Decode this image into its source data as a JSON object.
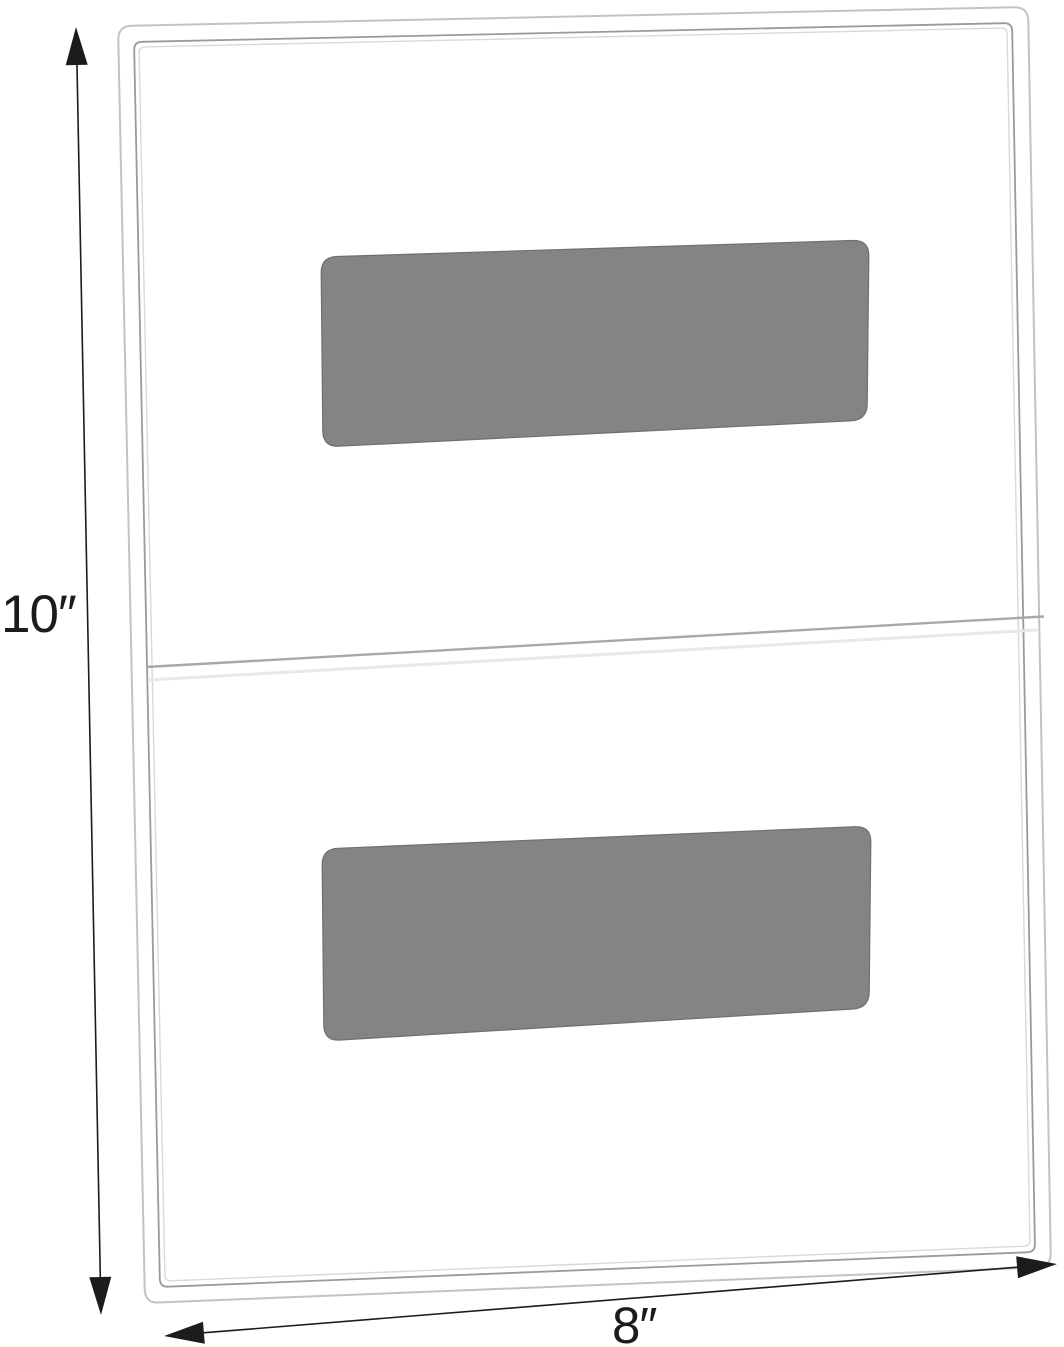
{
  "diagram": {
    "kind": "product-dimension-diagram",
    "dimension_labels": {
      "height": "10″",
      "width": "8″"
    },
    "colors": {
      "background": "#ffffff",
      "frame_outer_edge": "#c3c3c3",
      "frame_inner_edge": "#9a9a9a",
      "frame_inner_highlight": "#d9d9d9",
      "center_seam": "#a8a8a8",
      "center_seam_highlight": "#e8e8e8",
      "adhesive_pad": "#848484",
      "adhesive_pad_edge": "#6f6f6f",
      "dimension_arrow": "#1c1c1c",
      "label_text": "#1c1c1c"
    },
    "parts": {
      "frame": "clear acrylic sign holder panel",
      "adhesive_pad_top": "gray adhesive strip (top)",
      "adhesive_pad_bottom": "gray adhesive strip (bottom)",
      "center_seam": "horizontal panel seam at mid-height",
      "height_arrow": "vertical double-headed dimension arrow",
      "width_arrow": "horizontal double-headed dimension arrow"
    }
  }
}
